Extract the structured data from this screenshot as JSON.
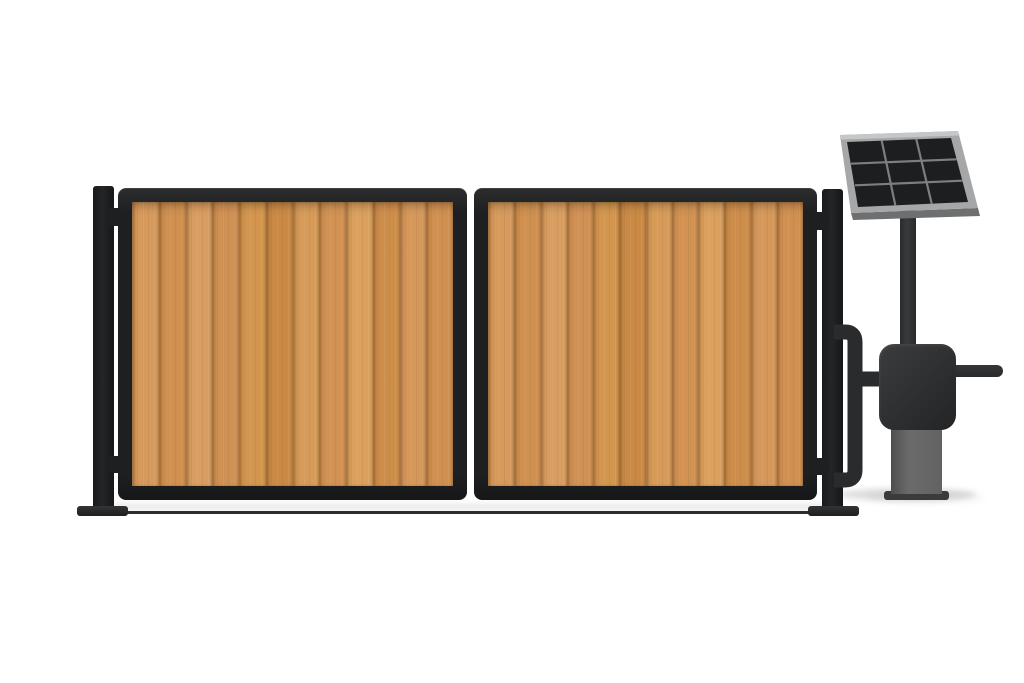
{
  "app": {
    "title": "Product render: double swing gate with vertical wood infill, steel posts and solar-powered gate opener station"
  },
  "scene": {
    "background": "#ffffff",
    "objects": [
      "left-gate-post",
      "gate-leaf-left",
      "gate-leaf-right",
      "right-gate-post",
      "hinges",
      "conduit-pipe",
      "gate-motor-box",
      "gate-opener-arm",
      "motor-pedestal",
      "solar-panel-pole",
      "solar-panel",
      "ground-line",
      "shadows"
    ],
    "colors": {
      "background": "#ffffff",
      "frame": "#1e1f20",
      "post": "#242526",
      "pipe": "#2a2b2c",
      "motor_box": "#2e2f30",
      "pedestal": "#6b6b6b",
      "pedestal_base": "#3a3b3c",
      "pole": "#3a3b3c",
      "panel_frame": "#a6a7a8",
      "panel_frame_light": "#c6c7c8",
      "panel_frame_edge": "#6e6f70",
      "panel_cell": "#1d1e1f",
      "panel_grid": "#7d7e80",
      "ground": "#2b2c2d",
      "wood_groove": "#a06a30"
    }
  },
  "gate": {
    "leaf_count": 2,
    "planks_per_leaf": 12,
    "plank_colors": [
      "#d69a5c",
      "#cf9050",
      "#d89d60",
      "#d09154",
      "#d3964f",
      "#ca8a46",
      "#d79b59",
      "#d19253",
      "#db9f5e",
      "#ce8e4b",
      "#d5985a",
      "#d09051"
    ]
  },
  "solar_panel": {
    "rows": 3,
    "cols": 3
  }
}
